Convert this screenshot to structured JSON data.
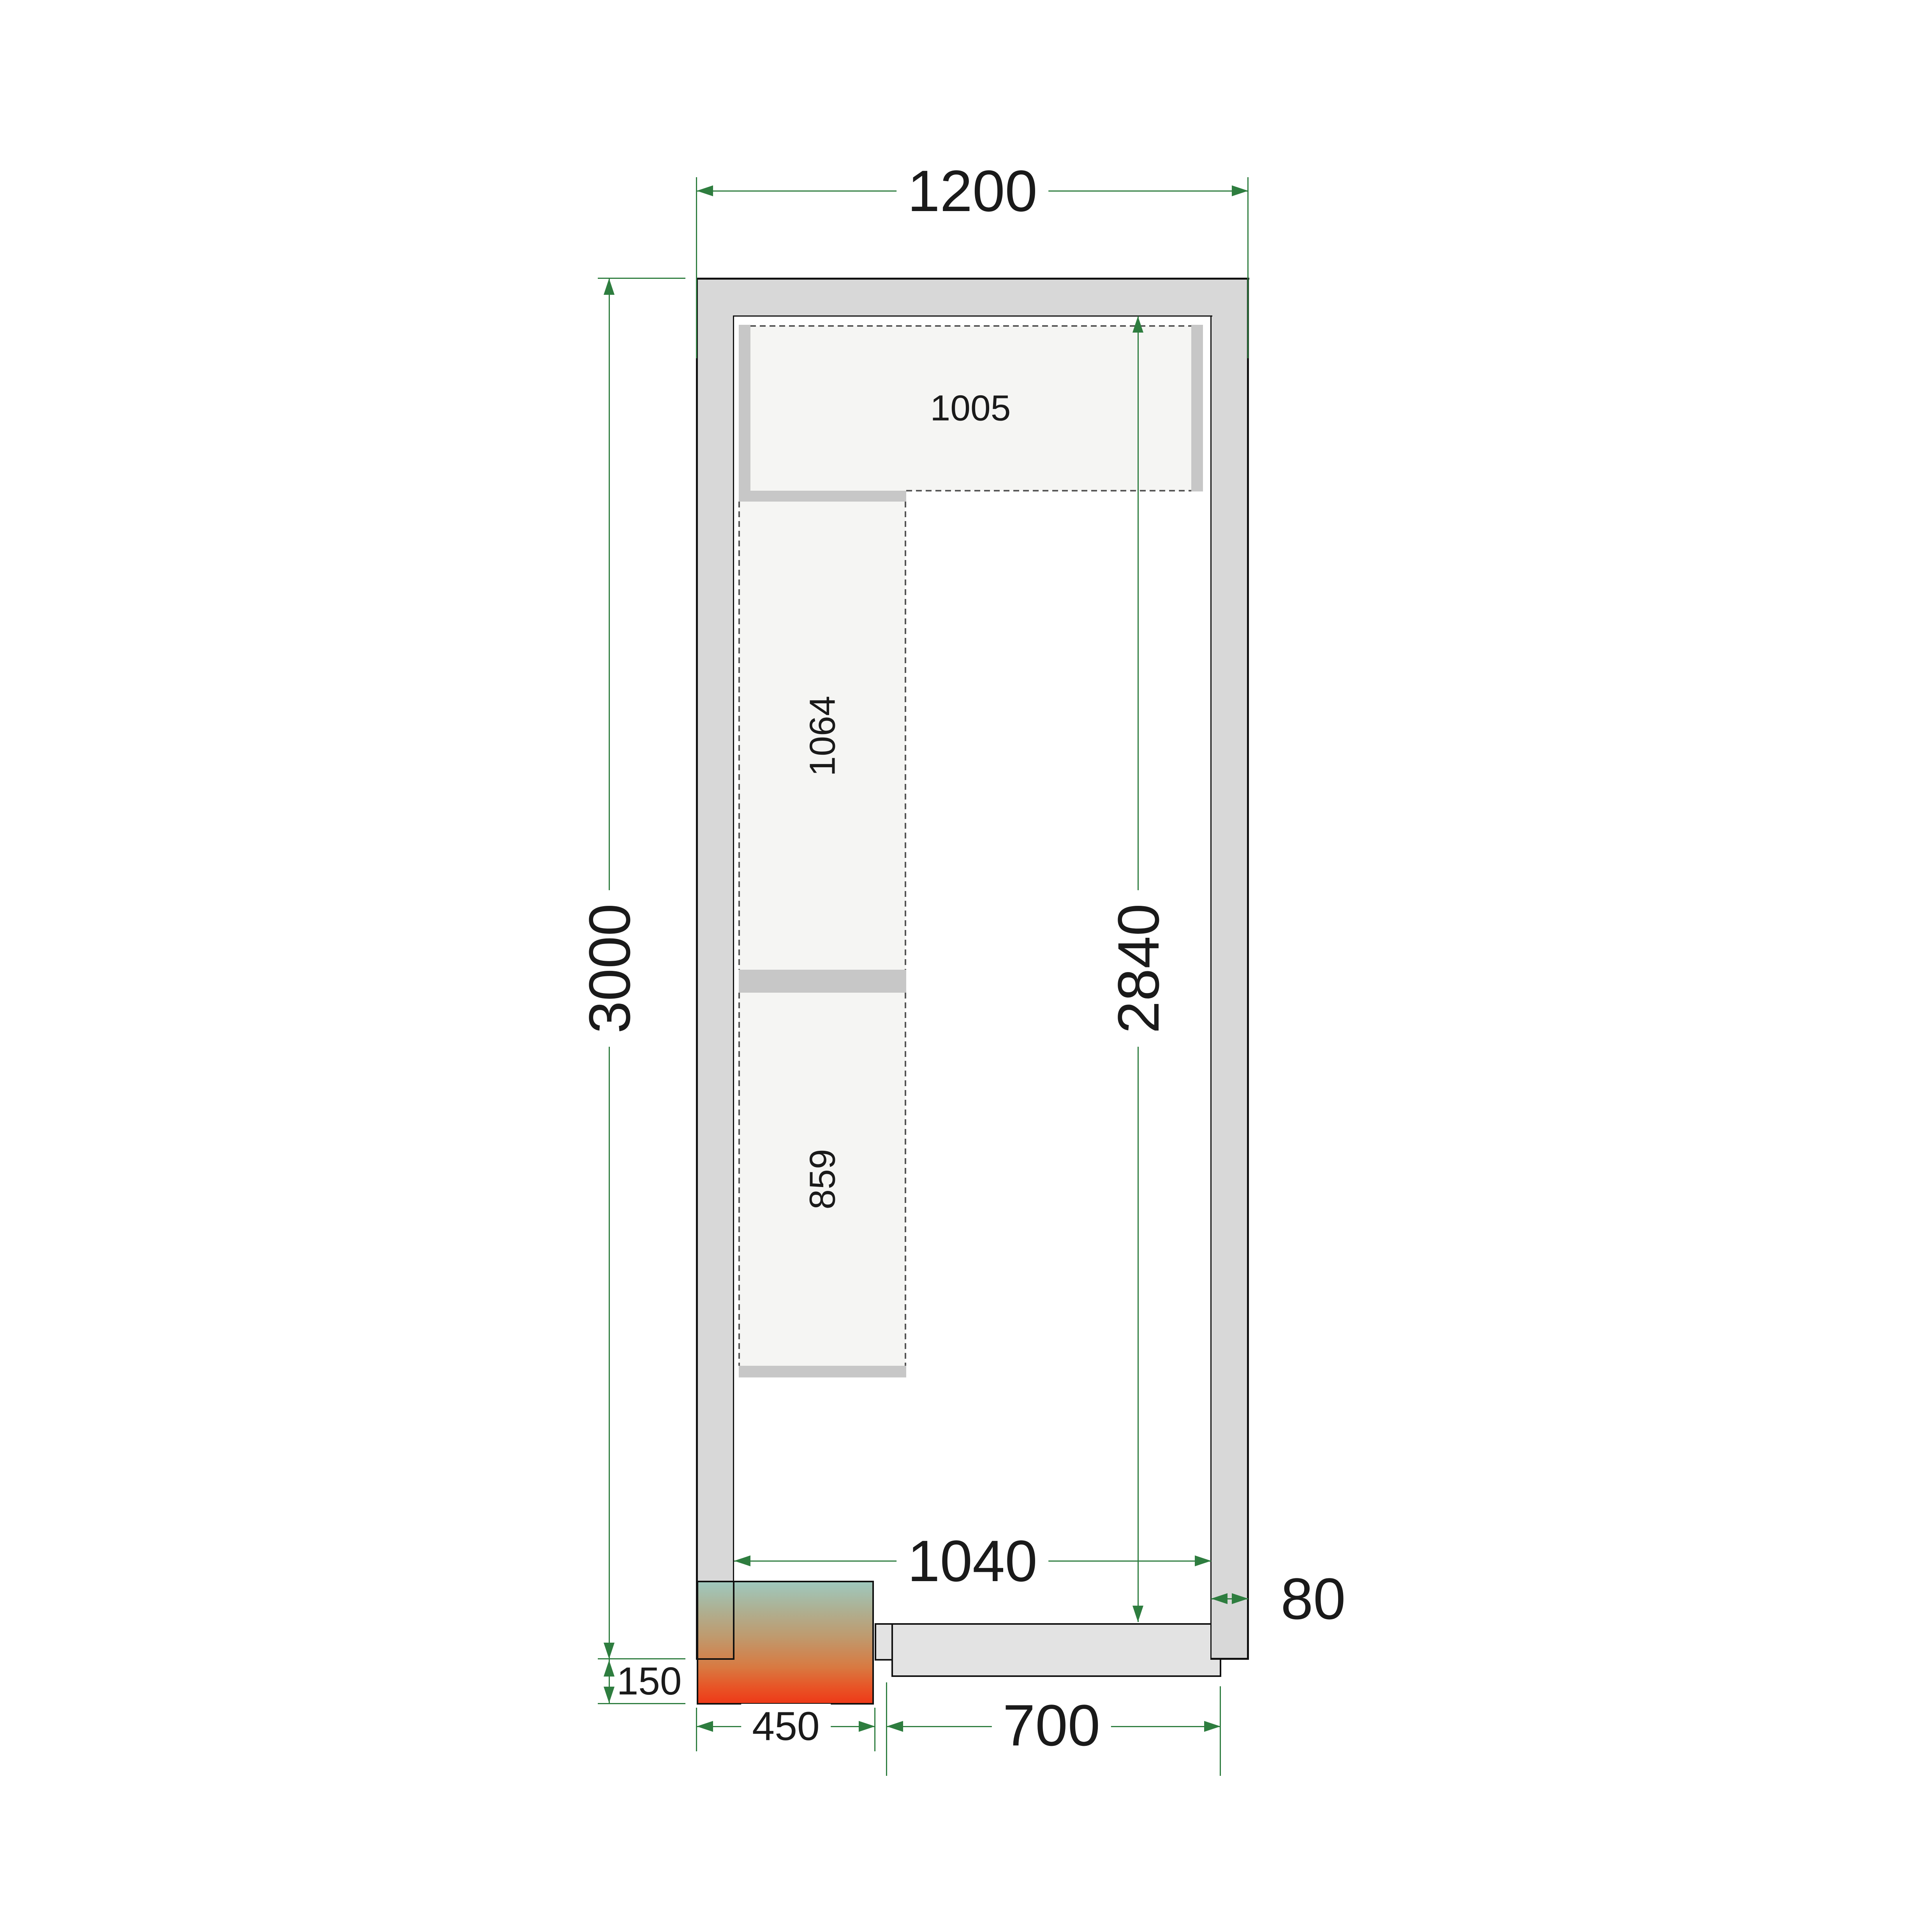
{
  "diagram": {
    "type": "cold-room-floor-plan",
    "colors": {
      "wall_fill": "#d8d8d8",
      "outline": "#101010",
      "shelf_fill": "#f5f5f3",
      "shelf_support": "#c7c7c7",
      "dashed_edge": "#555555",
      "dimension_green": "#2e7d3f",
      "door_fill": "#e3e3e3",
      "unit_gradient_top": "#9fc8bd",
      "unit_gradient_bottom": "#ee3a18",
      "text": "#1a1a1a"
    },
    "dimensions_mm": {
      "outer_width": "1200",
      "outer_depth": "3000",
      "inner_depth": "2840",
      "inner_width": "1040",
      "wall_thickness": "80",
      "unit_protrusion": "150",
      "unit_width": "450",
      "door_width": "700"
    },
    "shelf_labels": {
      "top_shelf": "1005",
      "left_shelf_upper": "1064",
      "left_shelf_lower": "859"
    }
  }
}
